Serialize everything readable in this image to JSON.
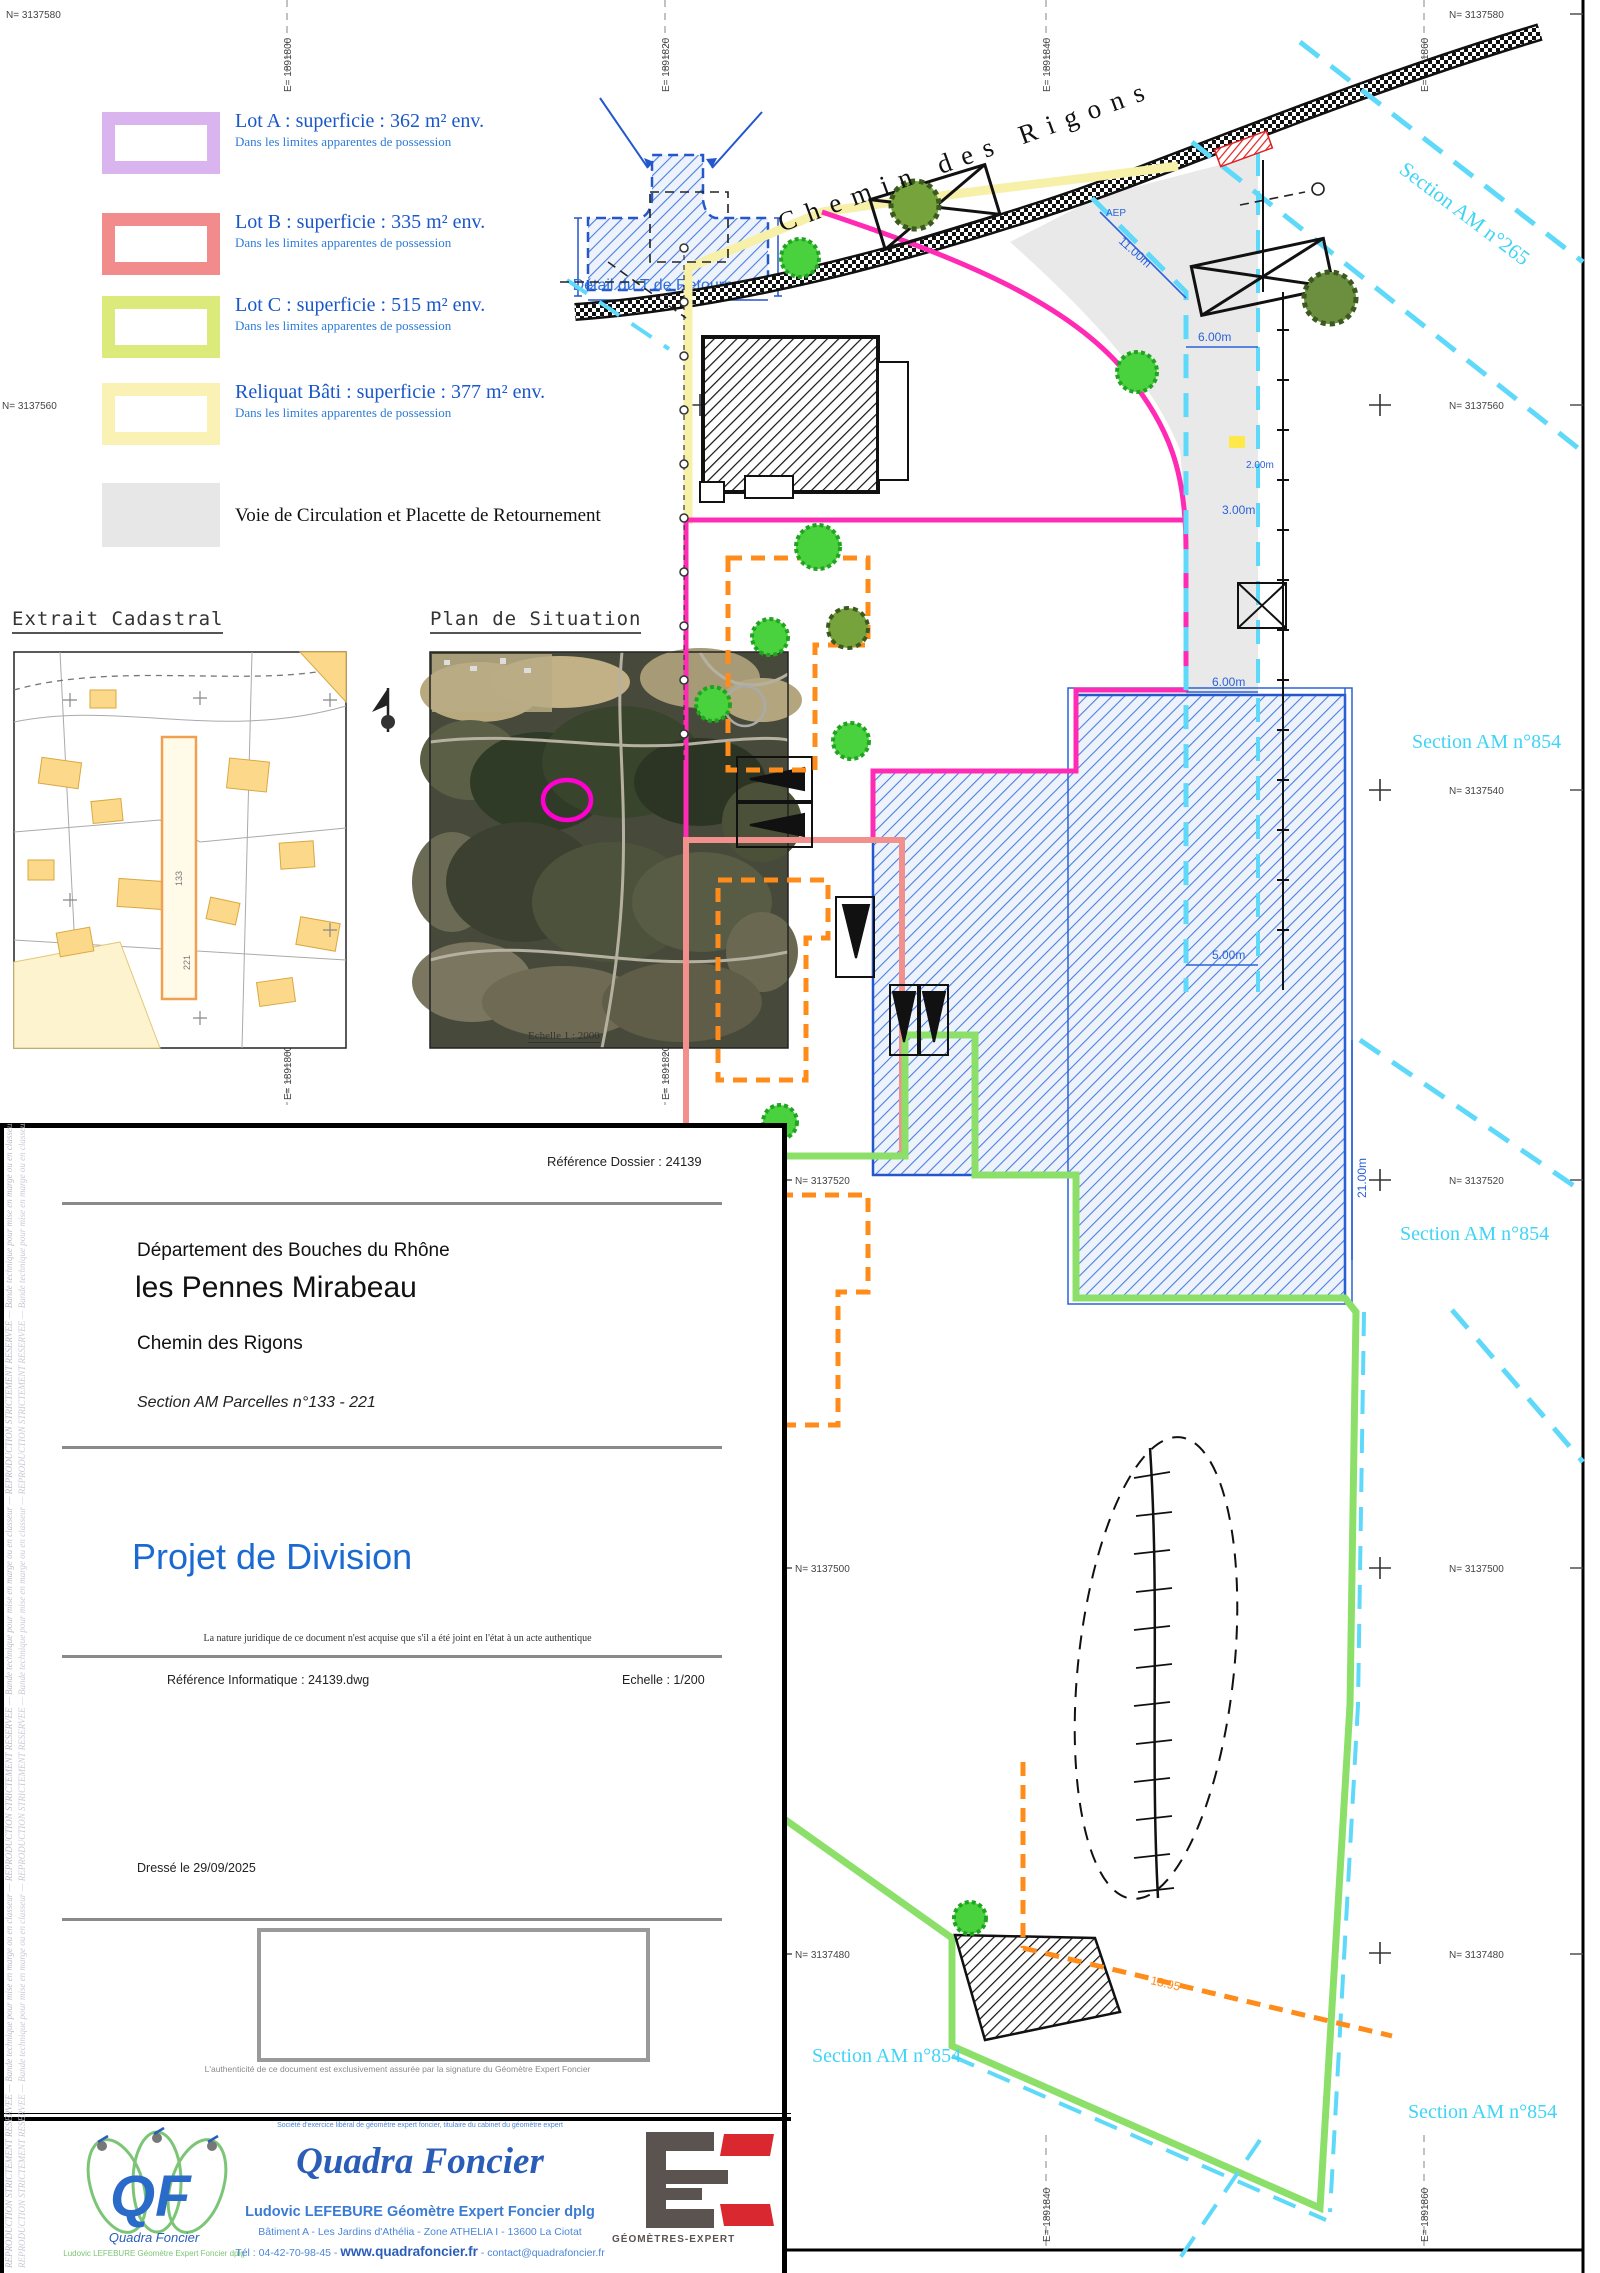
{
  "colors": {
    "lot_a": "#d9b4ef",
    "lot_b": "#f28b8b",
    "lot_c": "#dcea7c",
    "reliquat": "#faf2b4",
    "voie": "#e7e7e7",
    "magenta": "#ff2bb5",
    "green": "#8ce06a",
    "cyan": "#5fd9f9",
    "orange": "#ff8c1a",
    "dim_blue": "#2b62d9",
    "legend_blue": "#1a57c8",
    "title_blue": "#1b6ad2"
  },
  "legend": {
    "items": [
      {
        "title": "Lot A : superficie : 362 m² env.",
        "sub": "Dans les limites apparentes de possession"
      },
      {
        "title": "Lot B : superficie : 335 m² env.",
        "sub": "Dans les limites apparentes de possession"
      },
      {
        "title": "Lot C : superficie : 515 m² env.",
        "sub": "Dans les limites apparentes de possession"
      },
      {
        "title": "Reliquat Bâti : superficie : 377 m² env.",
        "sub": "Dans les limites apparentes de possession"
      },
      {
        "title": "Voie de Circulation et Placette de Retournement",
        "sub": ""
      }
    ]
  },
  "detail_t": {
    "label": "Détail du T de Retournement"
  },
  "panels": {
    "cadastral": {
      "title": "Extrait Cadastral",
      "scale_note": "Echelle 1 : 2000",
      "parcel_numbers": [
        "133",
        "221"
      ]
    },
    "situation": {
      "title": "Plan de Situation"
    }
  },
  "grid": {
    "n_labels": [
      "N= 3137580",
      "N= 3137560",
      "N= 3137540",
      "N= 3137520",
      "N= 3137500",
      "N= 3137480"
    ],
    "e_labels": [
      "E= 1891800",
      "E= 1891820",
      "E= 1891840",
      "E= 1891860"
    ]
  },
  "map": {
    "road_label": "Chemin des Rigons",
    "section_265": "Section AM n°265",
    "section_854": "Section AM n°854",
    "aep_label": "AEP",
    "dims": {
      "d1": "11.00m",
      "d2": "6.00m",
      "d3": "2.00m",
      "d4": "3.00m",
      "d5": "6.00m",
      "d6": "5.00m",
      "d7": "21.00m",
      "d8": "13.95"
    }
  },
  "cartouche": {
    "reference_dossier": "Référence Dossier : 24139",
    "departement": "Département des Bouches du Rhône",
    "commune": "les Pennes Mirabeau",
    "adresse": "Chemin des Rigons",
    "section": "Section AM Parcelles n°133 - 221",
    "titre": "Projet de Division",
    "nature": "La nature juridique de ce document n'est acquise que s'il a été joint en l'état à un acte authentique",
    "reference_informatique": "Référence Informatique : 24139.dwg",
    "echelle": "Echelle : 1/200",
    "dresse": "Dressé le 29/09/2025",
    "authenticite": "L'authenticité de ce document est exclusivement assurée par la signature du Géomètre Expert Foncier",
    "marge": "REPRODUCTION STRICTEMENT RESERVEE — Bande technique pour mise en marge ou en classeur — REPRODUCTION STRICTEMENT RESERVEE — Bande technique pour mise en marge ou en classeur — REPRODUCTION STRICTEMENT RESERVEE — Bande technique pour mise en marge ou en classeur"
  },
  "footer": {
    "tagline": "Société d'exercice libéral de géomètre expert foncier, titulaire du cabinet du géomètre expert",
    "company": "Quadra Foncier",
    "geometre": "Ludovic LEFEBURE Géomètre Expert Foncier dplg",
    "adresse": "Bâtiment A - Les Jardins d'Athélia - Zone ATHELIA I - 13600 La Ciotat",
    "tel_prefix": "Tél : 04-42-70-98-45 - ",
    "site": "www.quadrafoncier.fr",
    "email_suffix": " - contact@quadrafoncier.fr",
    "ge_logo_text": "GÉOMÈTRES-EXPERT"
  }
}
